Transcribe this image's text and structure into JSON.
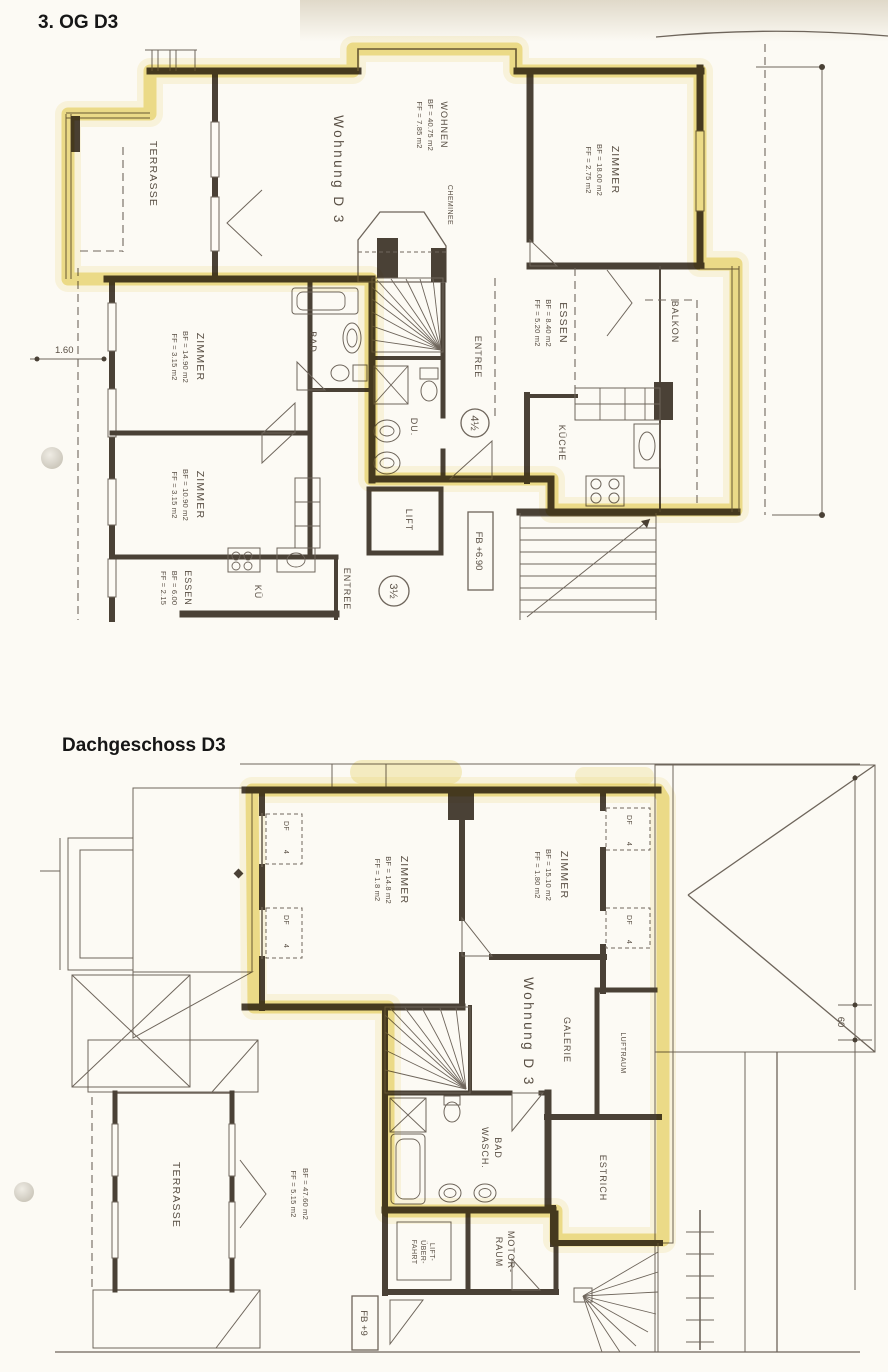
{
  "colors": {
    "paper": "#fcfaf4",
    "ink": "#4a4136",
    "thin_line": "#6e655b",
    "highlight": "#e3c93e",
    "text": "#584e43"
  },
  "plans": {
    "og": {
      "title": "3. OG D3",
      "terrasse": "TERRASSE",
      "wohnung": "Wohnung D 3",
      "wohnen": {
        "name": "WOHNEN",
        "bf": "BF = 40.75 m2",
        "ff": "FF = 7.85 m2"
      },
      "cheminee": "CHEMINEE",
      "zimmer_ne": {
        "name": "ZIMMER",
        "bf": "BF = 18.00 m2",
        "ff": "FF = 2.75 m2"
      },
      "essen_e": {
        "name": "ESSEN",
        "bf": "BF = 8.40 m2",
        "ff": "FF = 5.20 m2"
      },
      "balkon": "BALKON",
      "kueche": "KÜCHE",
      "entree": "ENTREE",
      "du": "DU.",
      "badge_45": "4½",
      "zimmer_w1": {
        "name": "ZIMMER",
        "bf": "BF = 14.90 m2",
        "ff": "FF = 3.15 m2"
      },
      "bad": "BAD",
      "zimmer_w2": {
        "name": "ZIMMER",
        "bf": "BF = 10.90 m2",
        "ff": "FF = 3.15 m2"
      },
      "essen_s": {
        "name": "ESSEN",
        "bf": "BF = 6.00",
        "ff": "FF = 2.15"
      },
      "kue": "KÜ",
      "entree2": "ENTREE",
      "lift": "LIFT",
      "level": "FB +6.90",
      "badge_35": "3½",
      "dim": "1.60"
    },
    "dg": {
      "title": "Dachgeschoss D3",
      "zimmer_l": {
        "name": "ZIMMER",
        "bf": "BF = 14.8 m2",
        "ff": "FF = 1.8 m2"
      },
      "zimmer_r": {
        "name": "ZIMMER",
        "bf": "BF = 15.10 m2",
        "ff": "FF = 1.80 m2"
      },
      "dormer": {
        "df": "DF",
        "num": "4"
      },
      "wohnung": "Wohnung D 3",
      "galerie": "GALERIE",
      "luftraum": "LUFTRAUM",
      "bad": {
        "l1": "BAD",
        "l2": "WASCH."
      },
      "estrich": "ESTRICH",
      "lift_shaft": {
        "l1": "LIFT-",
        "l2": "ÜBER-",
        "l3": "FAHRT"
      },
      "motor": {
        "l1": "MOTOR-",
        "l2": "RAUM"
      },
      "terrasse": "TERRASSE",
      "terrasse_stats": {
        "bf": "BF = 47.60 m2",
        "ff": "FF = 5.15 m2"
      },
      "level": "FB +9",
      "dim": "60"
    }
  }
}
